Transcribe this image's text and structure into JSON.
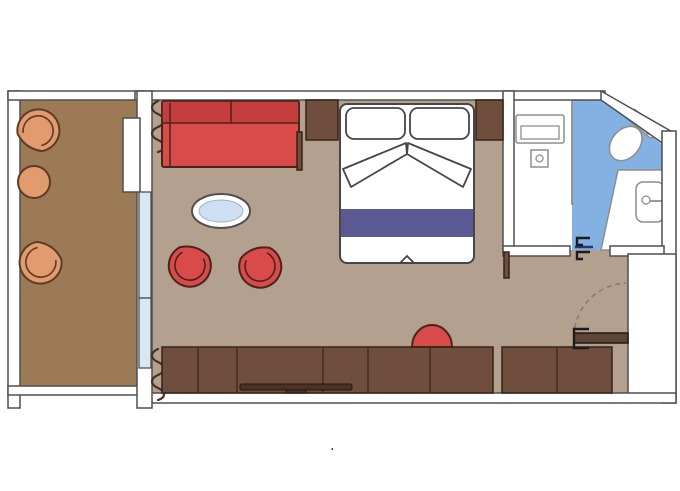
{
  "type": "cabin-floor-plan",
  "colors": {
    "bg": "#ffffff",
    "wall_fill": "#ffffff",
    "wall_stroke": "#4f4f4f",
    "room_floor": "#b3a08e",
    "balcony_floor": "#9c7a55",
    "bath_floor": "#82b1e2",
    "glass": "#d9e7f3",
    "glass_table": "#cde0f1",
    "red": "#d94b4b",
    "red_dark": "#c43e3e",
    "red_stroke": "#4a241a",
    "orange": "#e29b6e",
    "orange_stroke": "#5d3b24",
    "wood": "#6f4e3d",
    "wood_stroke": "#362317",
    "tv_fill": "#4a3326",
    "tv_stroke": "#241710",
    "bed_stroke": "#464646",
    "blanket": "#5a5991",
    "fixture_stroke": "#8e8e8e",
    "curtain": "#46301e",
    "door_wood": "#5d4434",
    "swing": "#8d7b68",
    "threshold": "#1e3a6e",
    "jamb": "#1c1c1c"
  },
  "plan": {
    "balcony": {
      "items": [
        "lounge-chair",
        "side-table",
        "lounge-chair"
      ]
    },
    "living_area": {
      "items": [
        "sofa",
        "coffee-table",
        "armchair",
        "armchair",
        "curtains",
        "sliding-glass-door"
      ]
    },
    "sleeping_area": {
      "items": [
        "double-bed",
        "pillow",
        "pillow",
        "nightstand",
        "nightstand"
      ]
    },
    "wardrobe_wall": {
      "items": [
        "wardrobe",
        "desk",
        "tv",
        "stool"
      ]
    },
    "bathroom": {
      "items": [
        "shower",
        "toilet",
        "sink",
        "vanity-counter"
      ]
    },
    "entry": {
      "items": [
        "entry-door",
        "door-swing"
      ]
    }
  },
  "footer_mark": "."
}
